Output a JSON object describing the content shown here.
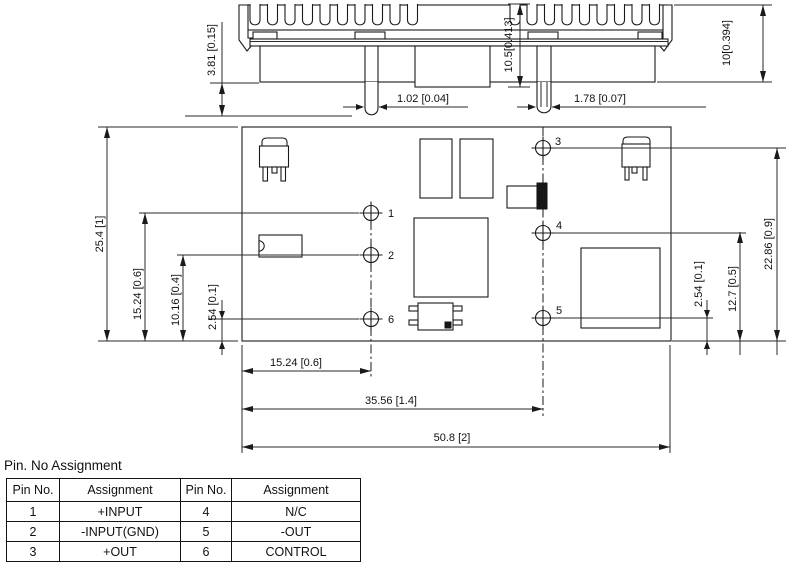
{
  "side_view": {
    "dim_pin_length": "3.81 [0.15]",
    "dim_height_mid": "10.5[0.413]",
    "dim_height_right": "10[0.394]",
    "dim_pin_width_left": "1.02 [0.04]",
    "dim_pin_width_right": "1.78 [0.07]"
  },
  "board_view": {
    "pin_labels": [
      "1",
      "2",
      "3",
      "4",
      "5",
      "6"
    ],
    "dim_board_height": "25.4 [1]",
    "dim_pin1_y": "15.24 [0.6]",
    "dim_pin2_y": "10.16 [0.4]",
    "dim_pin6_y": "2.54 [0.1]",
    "dim_pin3_y": "22.86 [0.9]",
    "dim_pin4_y": "12.7 [0.5]",
    "dim_pin5_y": "2.54 [0.1]",
    "dim_pin_col1_x": "15.24 [0.6]",
    "dim_pin_col2_x": "35.56 [1.4]",
    "dim_board_width": "50.8 [2]"
  },
  "pin_table": {
    "title": "Pin. No Assignment",
    "headers": [
      "Pin No.",
      "Assignment",
      "Pin No.",
      "Assignment"
    ],
    "rows": [
      [
        "1",
        "+INPUT",
        "4",
        "N/C"
      ],
      [
        "2",
        "-INPUT(GND)",
        "5",
        "-OUT"
      ],
      [
        "3",
        "+OUT",
        "6",
        "CONTROL"
      ]
    ]
  }
}
